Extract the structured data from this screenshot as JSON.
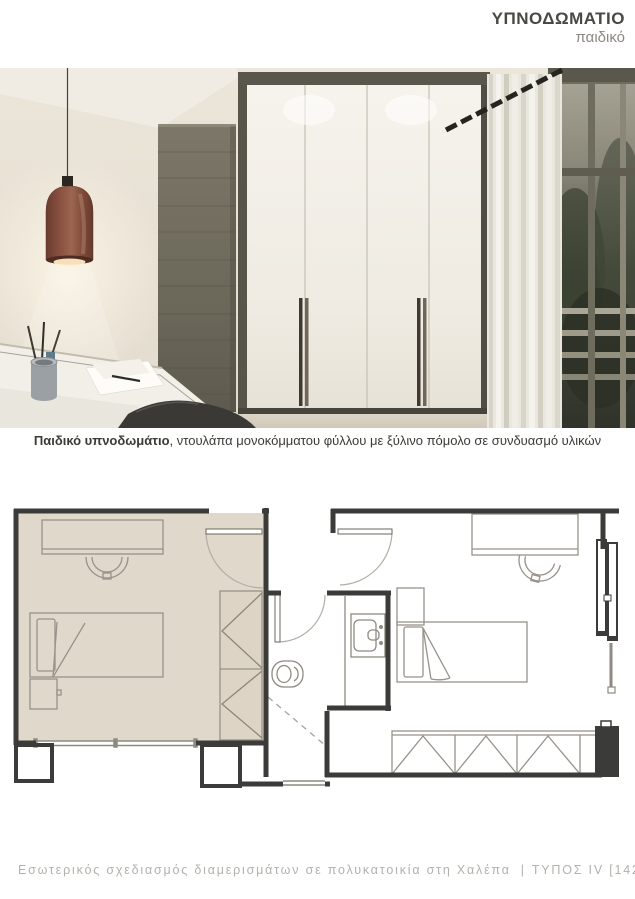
{
  "header": {
    "title": "ΥΠΝΟΔΩΜΑΤΙΟ",
    "subtitle": "παιδικό"
  },
  "caption": {
    "lead": "Παιδικό υπνοδωμάτιο",
    "rest": ", ντουλάπα μονοκόμματου φύλλου με ξύλινο πόμολο σε συνδυασμό υλικών"
  },
  "render": {
    "description": "3D render of a children's bedroom: white built-in wardrobe with wooden handles, dark wood accent panel, terracotta pendant lamp over a desk, sheer curtain and balcony glass door",
    "colors": {
      "wall_cream": "#e8e2d6",
      "wood_panel": "#6f6a5c",
      "wardrobe_white": "#f3f0ea",
      "lamp_terracotta": "#8a5140",
      "curtain": "#eae7df",
      "window_foliage": "#39402f"
    }
  },
  "floor_plan": {
    "highlighted_room": "παιδικό υπνοδωμάτιο",
    "highlight_color": "#e0d8ca",
    "wall_color": "#3b3b39",
    "elements": [
      "desk",
      "chair",
      "single bed",
      "nightstand",
      "wardrobe",
      "bathroom",
      "toilet",
      "sink",
      "shower",
      "windows",
      "doors"
    ]
  },
  "footer": {
    "project": "Εσωτερικός σχεδιασμός διαμερισμάτων σε πολυκατοικία στη Χαλέπα",
    "separator": "|",
    "type": "ΤΥΠΟΣ IV [142 τ.μ.]"
  }
}
